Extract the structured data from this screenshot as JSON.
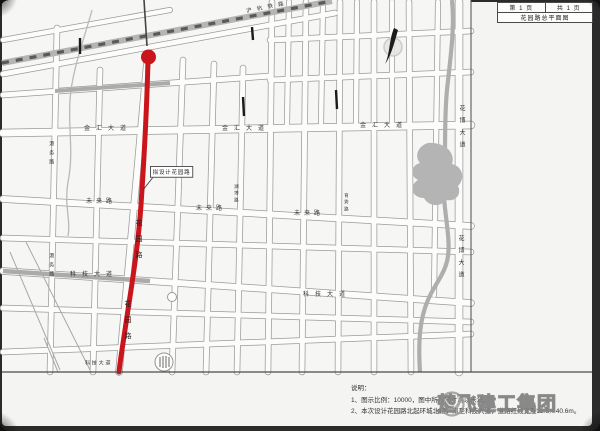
{
  "title_block": {
    "sheet_no": "第 1 页",
    "sheet_total": "共 1 页",
    "drawing_title": "花园路总平面图"
  },
  "map_labels": {
    "railway": "沪杭铁路",
    "jinhui_avenue": "金汇大道",
    "weilai_road": "未来路",
    "keji_avenue": "科技大道",
    "huabo_avenue": "花博大道",
    "huayuan_road": "花园路",
    "gangwu_road": "港务路",
    "side_street_a": "湖博路",
    "side_street_b": "育秀路",
    "proposed_tag": "拟设计花园路"
  },
  "notes": {
    "heading": "说明：",
    "line1": "1、图示比例：10000，图中所注尺寸均以米计。",
    "line2": "2、本次设计花园路北起环城北路，南至科技大道，道路红线宽度32.5／40.6m。"
  },
  "watermark": {
    "text": "楚飞建工集团"
  },
  "colors": {
    "route_red": "#c9151b",
    "water_gray": "#b2b2b2",
    "paper": "#f4f4f2"
  }
}
